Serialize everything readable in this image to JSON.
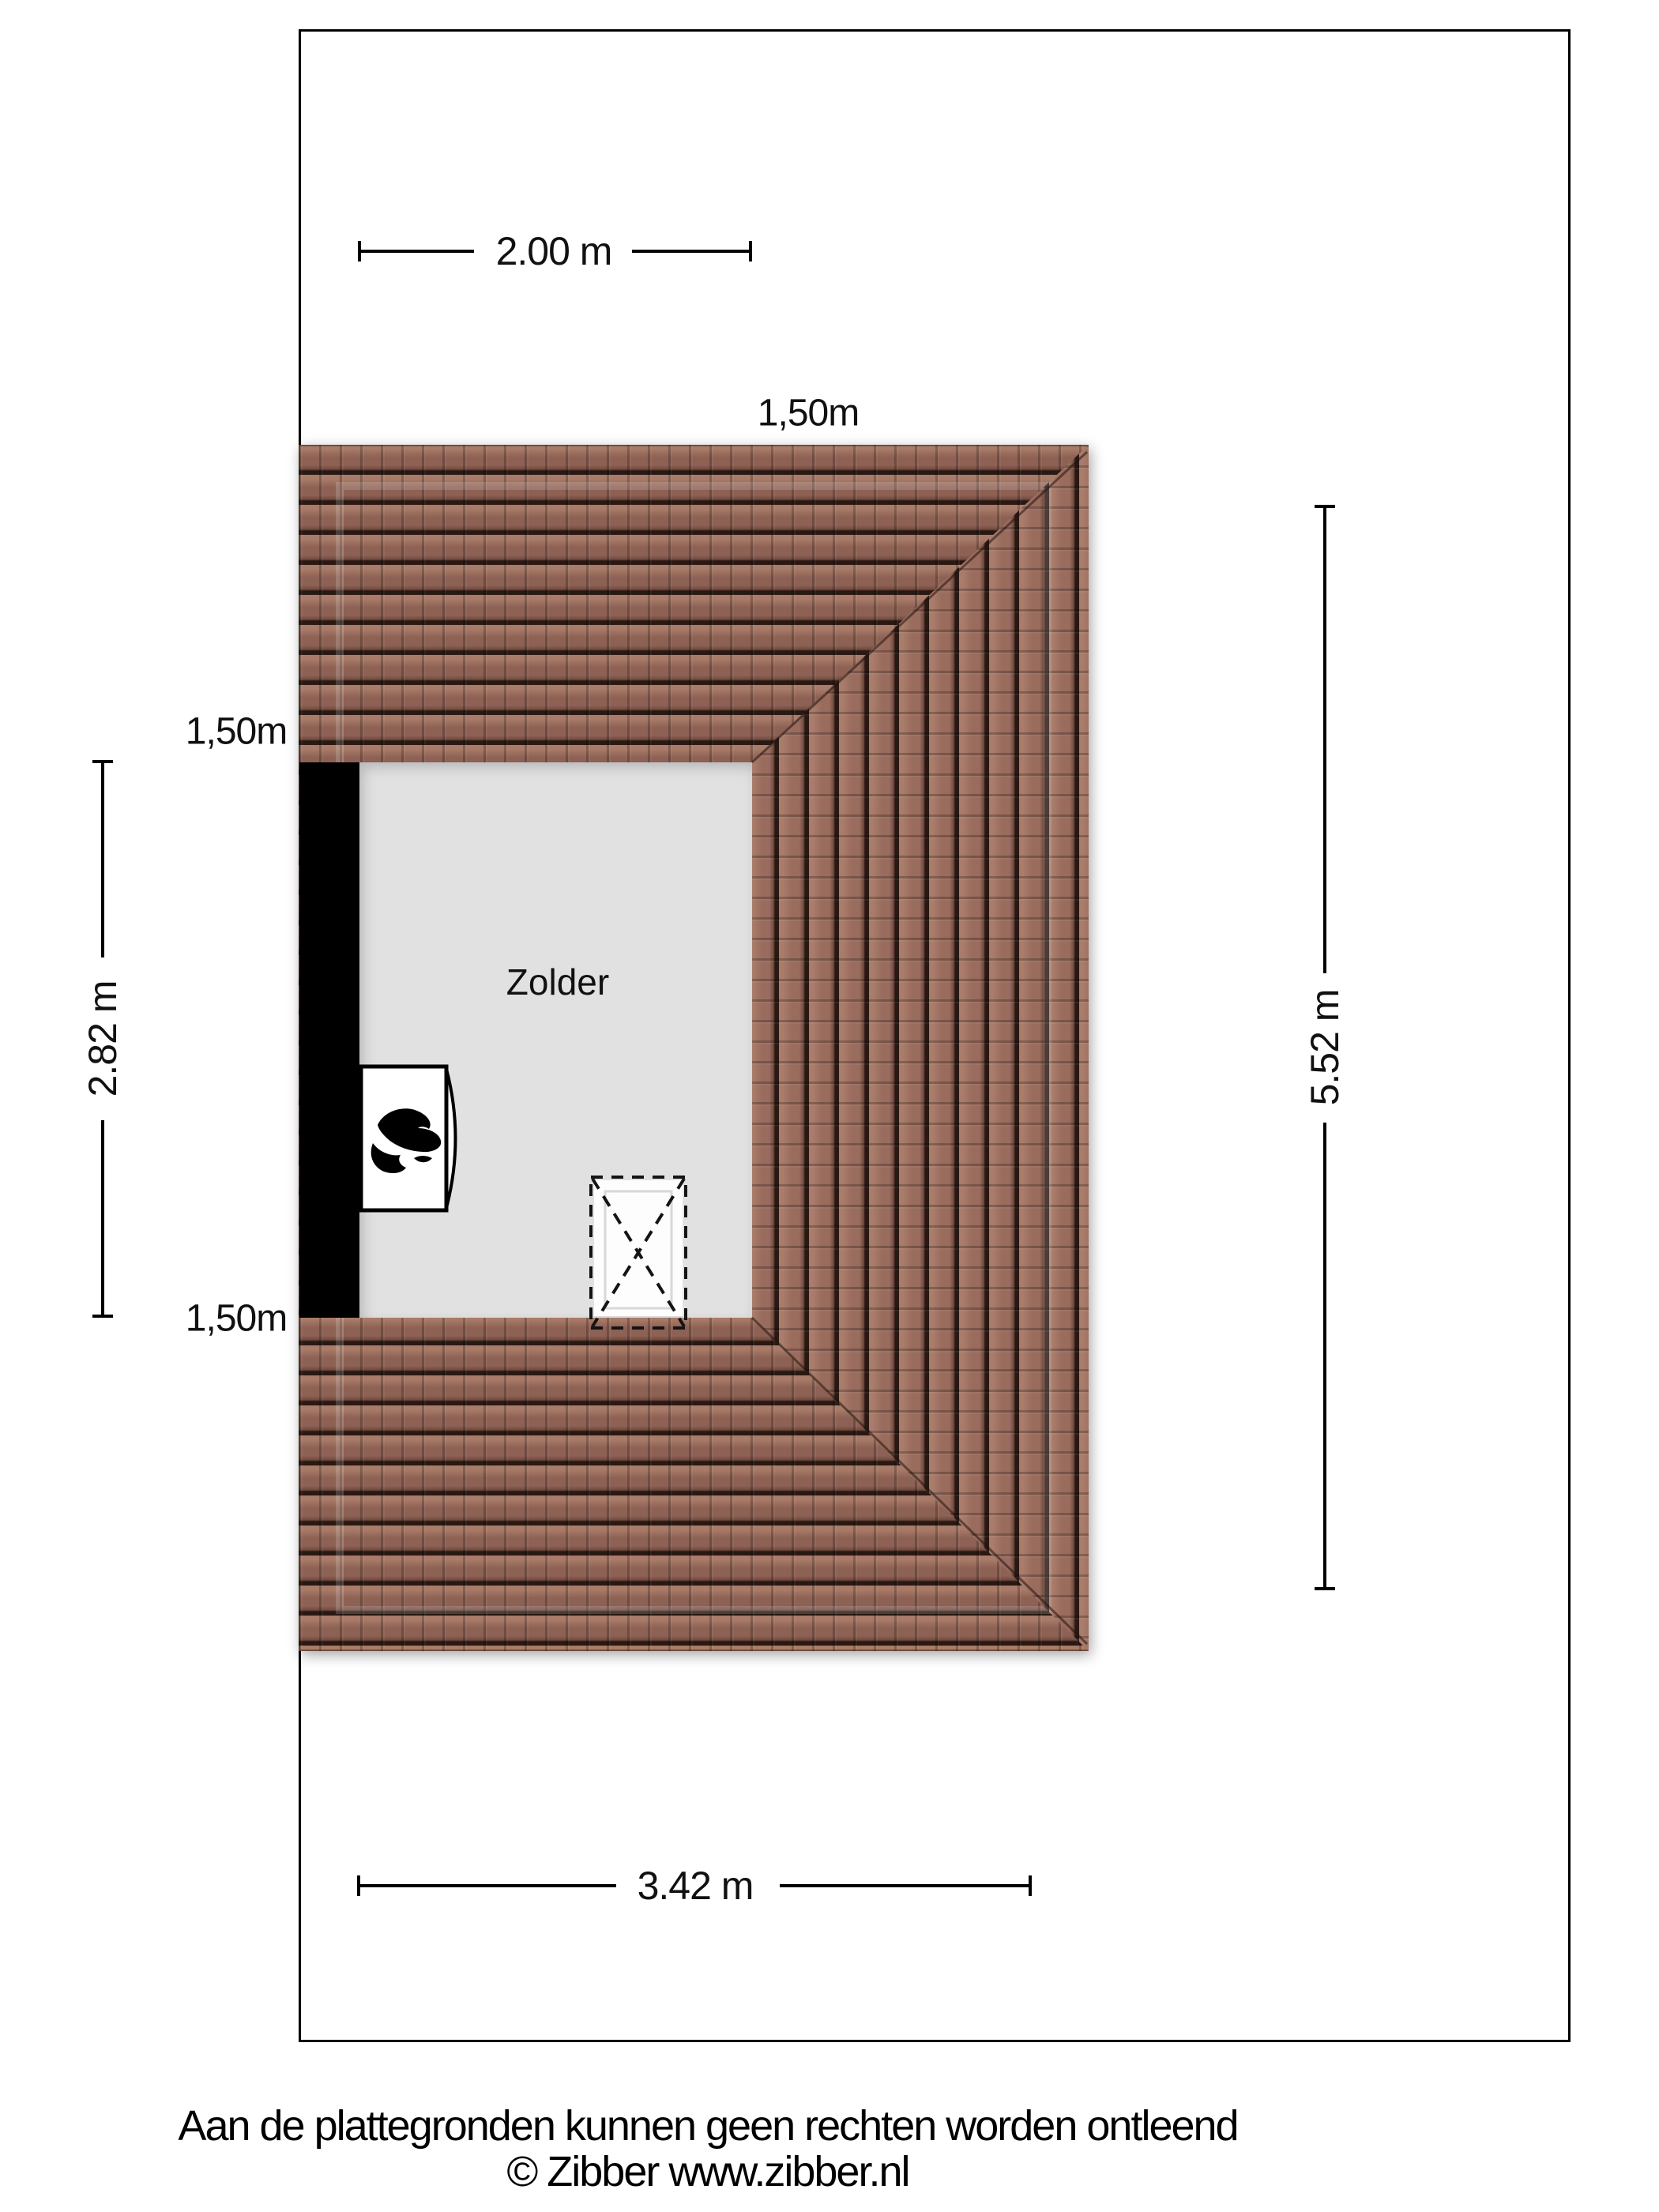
{
  "plan": {
    "room_label": "Zolder",
    "dimensions": {
      "top": "2.00 m",
      "bottom": "3.42 m",
      "left": "2.82 m",
      "right": "5.52 m"
    },
    "height_contours": {
      "top": "1,50m",
      "left_upper": "1,50m",
      "left_lower": "1,50m"
    },
    "colors": {
      "roof_tile_base": "#8d6154",
      "roof_tile_gap": "#2a1812",
      "room_fill": "#e1e1e1",
      "wall": "#000000",
      "page_background": "#ffffff"
    },
    "icons": {
      "boiler": "flame-icon",
      "stair_opening": "dashed-cross-box"
    }
  },
  "footer": {
    "disclaimer": "Aan de plattegronden kunnen geen rechten worden ontleend",
    "copyright": "© Zibber www.zibber.nl"
  }
}
